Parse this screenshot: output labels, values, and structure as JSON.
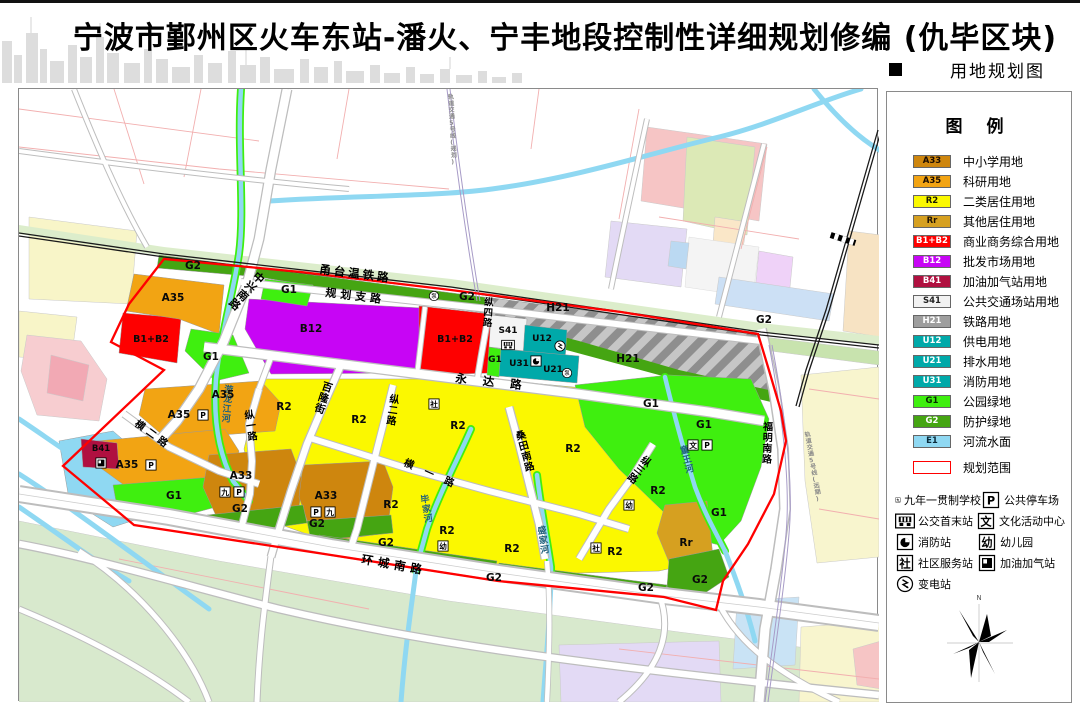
{
  "header": {
    "title": "宁波市鄞州区火车东站-潘火、宁丰地段控制性详细规划修编 (仇毕区块)",
    "map_type_label": "用地规划图"
  },
  "legend": {
    "title": "图  例",
    "items": [
      {
        "code": "A33",
        "label": "中小学用地",
        "color": "#CE860E",
        "text_color": "#1a0c00"
      },
      {
        "code": "A35",
        "label": "科研用地",
        "color": "#F2A413",
        "text_color": "#1a0c00"
      },
      {
        "code": "R2",
        "label": "二类居住用地",
        "color": "#FBF800",
        "text_color": "#1a1a00"
      },
      {
        "code": "Rr",
        "label": "其他居住用地",
        "color": "#D6A020",
        "text_color": "#231400"
      },
      {
        "code": "B1+B2",
        "label": "商业商务综合用地",
        "color": "#FE0000",
        "text_color": "#ffffff"
      },
      {
        "code": "B12",
        "label": "批发市场用地",
        "color": "#C705F5",
        "text_color": "#ffffff"
      },
      {
        "code": "B41",
        "label": "加油加气站用地",
        "color": "#B01040",
        "text_color": "#ffffff"
      },
      {
        "code": "S41",
        "label": "公共交通场站用地",
        "color": "#F2F2F2",
        "text_color": "#222222"
      },
      {
        "code": "H21",
        "label": "铁路用地",
        "color": "#9E9E9E",
        "text_color": "#ffffff"
      },
      {
        "code": "U12",
        "label": "供电用地",
        "color": "#00A9A9",
        "text_color": "#ffffff"
      },
      {
        "code": "U21",
        "label": "排水用地",
        "color": "#00A9A9",
        "text_color": "#ffffff"
      },
      {
        "code": "U31",
        "label": "消防用地",
        "color": "#00A9A9",
        "text_color": "#ffffff"
      },
      {
        "code": "G1",
        "label": "公园绿地",
        "color": "#3FEF0F",
        "text_color": "#062a00"
      },
      {
        "code": "G2",
        "label": "防护绿地",
        "color": "#45A512",
        "text_color": "#ffffff"
      },
      {
        "code": "E1",
        "label": "河流水面",
        "color": "#8FD8F2",
        "text_color": "#0a2a3a"
      }
    ],
    "boundary": {
      "label": "规划范围",
      "color": "#FF0000"
    },
    "symbols": [
      {
        "kind": "box",
        "glyph": "九",
        "label": "九年一贯制学校"
      },
      {
        "kind": "box",
        "glyph": "P",
        "label": "公共停车场"
      },
      {
        "kind": "bus",
        "glyph": "",
        "label": "公交首末站"
      },
      {
        "kind": "box",
        "glyph": "文",
        "label": "文化活动中心"
      },
      {
        "kind": "fire",
        "glyph": "",
        "label": "消防站"
      },
      {
        "kind": "box",
        "glyph": "幼",
        "label": "幼儿园"
      },
      {
        "kind": "box",
        "glyph": "社",
        "label": "社区服务站"
      },
      {
        "kind": "gas",
        "glyph": "",
        "label": "加油加气站"
      },
      {
        "kind": "sub",
        "glyph": "",
        "label": "变电站"
      }
    ],
    "compass_n": "N"
  },
  "map": {
    "zone_labels": [
      {
        "t": "A35",
        "x": 154,
        "y": 212
      },
      {
        "t": "A35",
        "x": 204,
        "y": 309
      },
      {
        "t": "A35",
        "x": 160,
        "y": 329
      },
      {
        "t": "A35",
        "x": 108,
        "y": 379
      },
      {
        "t": "A33",
        "x": 222,
        "y": 390
      },
      {
        "t": "A33",
        "x": 307,
        "y": 410
      },
      {
        "t": "R2",
        "x": 265,
        "y": 321
      },
      {
        "t": "R2",
        "x": 340,
        "y": 334
      },
      {
        "t": "R2",
        "x": 439,
        "y": 340
      },
      {
        "t": "R2",
        "x": 372,
        "y": 419
      },
      {
        "t": "R2",
        "x": 428,
        "y": 445
      },
      {
        "t": "R2",
        "x": 493,
        "y": 463
      },
      {
        "t": "R2",
        "x": 554,
        "y": 363
      },
      {
        "t": "R2",
        "x": 639,
        "y": 405
      },
      {
        "t": "R2",
        "x": 596,
        "y": 466
      },
      {
        "t": "Rr",
        "x": 667,
        "y": 457
      },
      {
        "t": "B1+B2",
        "x": 132,
        "y": 253,
        "s": 9.5
      },
      {
        "t": "B1+B2",
        "x": 436,
        "y": 253,
        "s": 9.5
      },
      {
        "t": "B12",
        "x": 292,
        "y": 243
      },
      {
        "t": "B41",
        "x": 82,
        "y": 362,
        "s": 8.5
      },
      {
        "t": "G1",
        "x": 270,
        "y": 204
      },
      {
        "t": "G1",
        "x": 192,
        "y": 271
      },
      {
        "t": "G1",
        "x": 476,
        "y": 273,
        "s": 9
      },
      {
        "t": "G1",
        "x": 155,
        "y": 410
      },
      {
        "t": "G1",
        "x": 632,
        "y": 318
      },
      {
        "t": "G1",
        "x": 685,
        "y": 339
      },
      {
        "t": "G1",
        "x": 700,
        "y": 427
      },
      {
        "t": "G2",
        "x": 174,
        "y": 180
      },
      {
        "t": "G2",
        "x": 448,
        "y": 211
      },
      {
        "t": "G2",
        "x": 745,
        "y": 234
      },
      {
        "t": "G2",
        "x": 221,
        "y": 423
      },
      {
        "t": "G2",
        "x": 298,
        "y": 438
      },
      {
        "t": "G2",
        "x": 367,
        "y": 457
      },
      {
        "t": "G2",
        "x": 475,
        "y": 492
      },
      {
        "t": "G2",
        "x": 627,
        "y": 502
      },
      {
        "t": "G2",
        "x": 681,
        "y": 494
      },
      {
        "t": "H21",
        "x": 539,
        "y": 222
      },
      {
        "t": "H21",
        "x": 609,
        "y": 273
      },
      {
        "t": "S41",
        "x": 489,
        "y": 244,
        "s": 9
      },
      {
        "t": "U12",
        "x": 523,
        "y": 252,
        "s": 9
      },
      {
        "t": "U31",
        "x": 500,
        "y": 277,
        "s": 9
      },
      {
        "t": "U21",
        "x": 534,
        "y": 283,
        "s": 9
      }
    ],
    "road_labels": [
      {
        "t": "甬台温铁路",
        "x": 300,
        "y": 184,
        "s": 11.5,
        "r": 7,
        "ls": 3
      },
      {
        "t": "规划支路",
        "x": 306,
        "y": 207,
        "s": 11,
        "r": 7,
        "ls": 4
      },
      {
        "t": "永达路",
        "x": 436,
        "y": 293,
        "s": 11.5,
        "r": 6,
        "ls": 16
      },
      {
        "t": "环城南路",
        "x": 342,
        "y": 474,
        "s": 11.5,
        "r": 10,
        "ls": 5
      },
      {
        "t": "中兴南路",
        "x": 233,
        "y": 188,
        "s": 11,
        "v": 1,
        "r": 42
      },
      {
        "t": "百隆街",
        "x": 302,
        "y": 300,
        "s": 10.5,
        "v": 1,
        "r": 18
      },
      {
        "t": "纵一路",
        "x": 226,
        "y": 330,
        "s": 10,
        "v": 1,
        "r": -8
      },
      {
        "t": "横二路",
        "x": 115,
        "y": 336,
        "s": 10,
        "r": 36,
        "ls": 4
      },
      {
        "t": "横一路",
        "x": 384,
        "y": 376,
        "s": 10,
        "r": 24,
        "ls": 12
      },
      {
        "t": "纵二路",
        "x": 370,
        "y": 313,
        "s": 10,
        "v": 1,
        "r": 8
      },
      {
        "t": "桑田南路",
        "x": 498,
        "y": 351,
        "s": 10,
        "v": 1,
        "r": -15
      },
      {
        "t": "纵三路",
        "x": 621,
        "y": 372,
        "s": 10,
        "v": 1,
        "r": 38
      },
      {
        "t": "纵四路",
        "x": 465,
        "y": 216,
        "s": 9.5,
        "v": 1,
        "r": 4
      },
      {
        "t": "福明南路",
        "x": 744,
        "y": 341,
        "s": 10,
        "v": 1,
        "r": 2
      },
      {
        "t": "游龙江河",
        "x": 205,
        "y": 303,
        "s": 9,
        "v": 1,
        "r": 5,
        "c": "#20607C"
      },
      {
        "t": "毕家河",
        "x": 402,
        "y": 414,
        "s": 9,
        "v": 1,
        "r": -10,
        "c": "#20607C"
      },
      {
        "t": "盛家河",
        "x": 519,
        "y": 445,
        "s": 9,
        "v": 1,
        "r": -8,
        "c": "#20607C"
      },
      {
        "t": "童王河",
        "x": 662,
        "y": 365,
        "s": 9,
        "v": 1,
        "r": -14,
        "c": "#20607C"
      },
      {
        "t": "轨道交通5号线(规划)",
        "x": 429,
        "y": 10,
        "s": 6,
        "v": 1,
        "r": -3,
        "c": "#8a8a8a"
      },
      {
        "t": "轨道交通5号线(远期)",
        "x": 786,
        "y": 348,
        "s": 6,
        "v": 1,
        "r": -10,
        "c": "#8a8a8a"
      }
    ],
    "icons": [
      {
        "k": "box",
        "g": "P",
        "x": 184,
        "y": 326
      },
      {
        "k": "box",
        "g": "P",
        "x": 132,
        "y": 376
      },
      {
        "k": "box",
        "g": "九",
        "x": 206,
        "y": 403
      },
      {
        "k": "box",
        "g": "P",
        "x": 220,
        "y": 403
      },
      {
        "k": "box",
        "g": "P",
        "x": 297,
        "y": 423
      },
      {
        "k": "box",
        "g": "九",
        "x": 311,
        "y": 423
      },
      {
        "k": "box",
        "g": "社",
        "x": 415,
        "y": 315
      },
      {
        "k": "box",
        "g": "社",
        "x": 577,
        "y": 459
      },
      {
        "k": "box",
        "g": "幼",
        "x": 424,
        "y": 457
      },
      {
        "k": "box",
        "g": "幼",
        "x": 610,
        "y": 416
      },
      {
        "k": "box",
        "g": "文",
        "x": 674,
        "y": 356
      },
      {
        "k": "box",
        "g": "P",
        "x": 688,
        "y": 356
      },
      {
        "k": "bus",
        "g": "",
        "x": 489,
        "y": 256
      },
      {
        "k": "fire",
        "g": "",
        "x": 517,
        "y": 272
      },
      {
        "k": "gas",
        "g": "",
        "x": 82,
        "y": 374
      },
      {
        "k": "sub",
        "g": "",
        "x": 541,
        "y": 257
      },
      {
        "k": "pump",
        "g": "泵",
        "x": 548,
        "y": 284
      },
      {
        "k": "pump",
        "g": "泵",
        "x": 415,
        "y": 207
      }
    ]
  }
}
